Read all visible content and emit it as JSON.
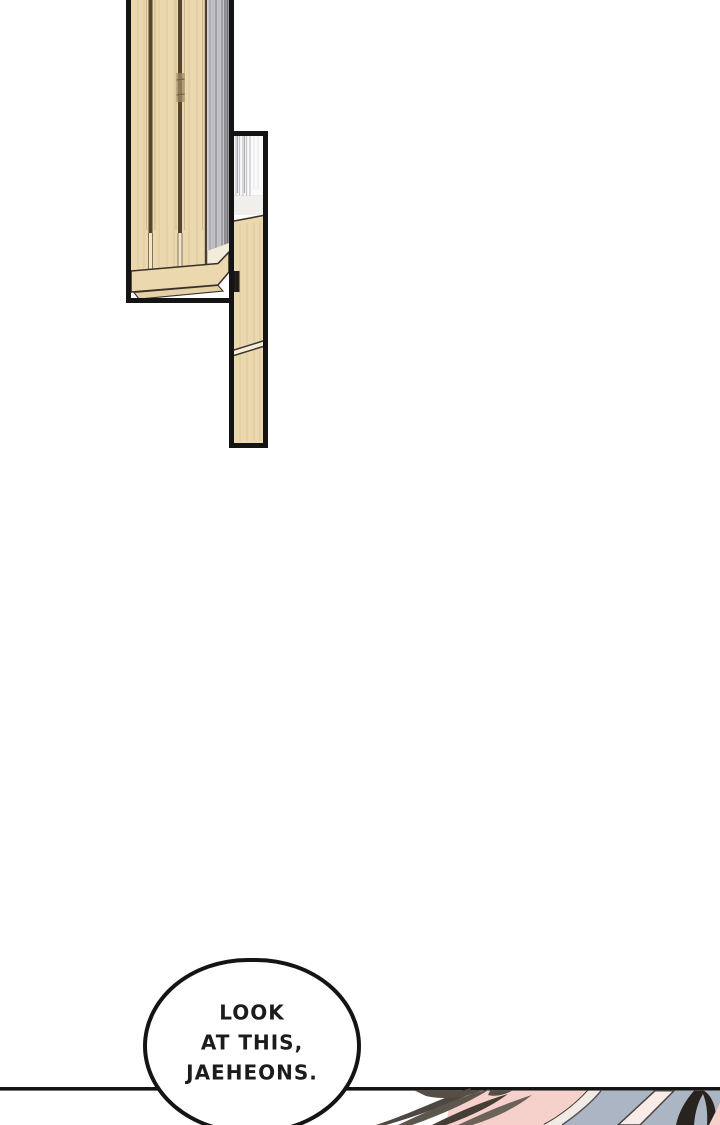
{
  "page": {
    "width": 720,
    "height": 1125,
    "background": "#ffffff"
  },
  "speech_bubble": {
    "lines": [
      "LOOK",
      "AT THIS,",
      "JAEHEONS."
    ]
  },
  "colors": {
    "page_bg": "#ffffff",
    "ink_black": "#141414",
    "bubble_fill": "#ffffff",
    "text_ink": "#1c1c1c",
    "wood": "#ebd8af",
    "wood_shade": "#e5d1a6",
    "wood_grain": "#dec79e",
    "wood_seam": "#54452f",
    "wood_outline": "#3a3128",
    "wood_top_light": "#f3ecdb",
    "curtain_gray": "#c7c7cb",
    "curtain_gray_dark": "#8b8b8f",
    "glass_white": "#fafafb",
    "glass_stripe": "#c3c3c8",
    "skin_pink": "#f6d0ca",
    "skin_cream": "#f2ebe5",
    "fabric_blue_gray": "#abb5c3",
    "hair_dark": "#28231f",
    "hair_brown": "#574f47",
    "contour_line": "#4a423a"
  }
}
